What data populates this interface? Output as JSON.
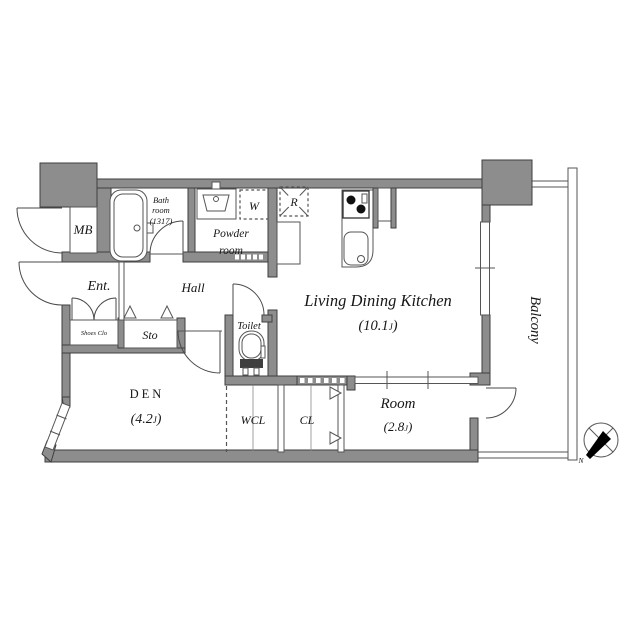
{
  "colors": {
    "wall_fill": "#8d8d8d",
    "wall_stroke": "#3e3e3e",
    "line": "#555555",
    "text": "#161616",
    "needle": "#000000",
    "bg": "#ffffff"
  },
  "rooms": {
    "ldk": {
      "name": "Living Dining Kitchen",
      "size_pre": "(10.1",
      "size_j": "J",
      "size_post": ")"
    },
    "room": {
      "name": "Room",
      "size_pre": "(2.8",
      "size_j": "J",
      "size_post": ")"
    },
    "den": {
      "name": "DEN",
      "size_pre": "(4.2",
      "size_j": "J",
      "size_post": ")"
    },
    "balcony": "Balcony",
    "hall": "Hall",
    "ent": "Ent.",
    "powder_line1": "Powder",
    "powder_line2": "room",
    "bath_line1": "Bath",
    "bath_line2": "room",
    "bath_line3": "(1317)",
    "toilet": "Toilet",
    "wcl": "WCL",
    "cl": "CL",
    "sto": "Sto",
    "shoes_clo": "Shoes Clo",
    "mb": "MB",
    "washer": "W",
    "fridge": "R"
  },
  "compass": {
    "north": "N"
  }
}
